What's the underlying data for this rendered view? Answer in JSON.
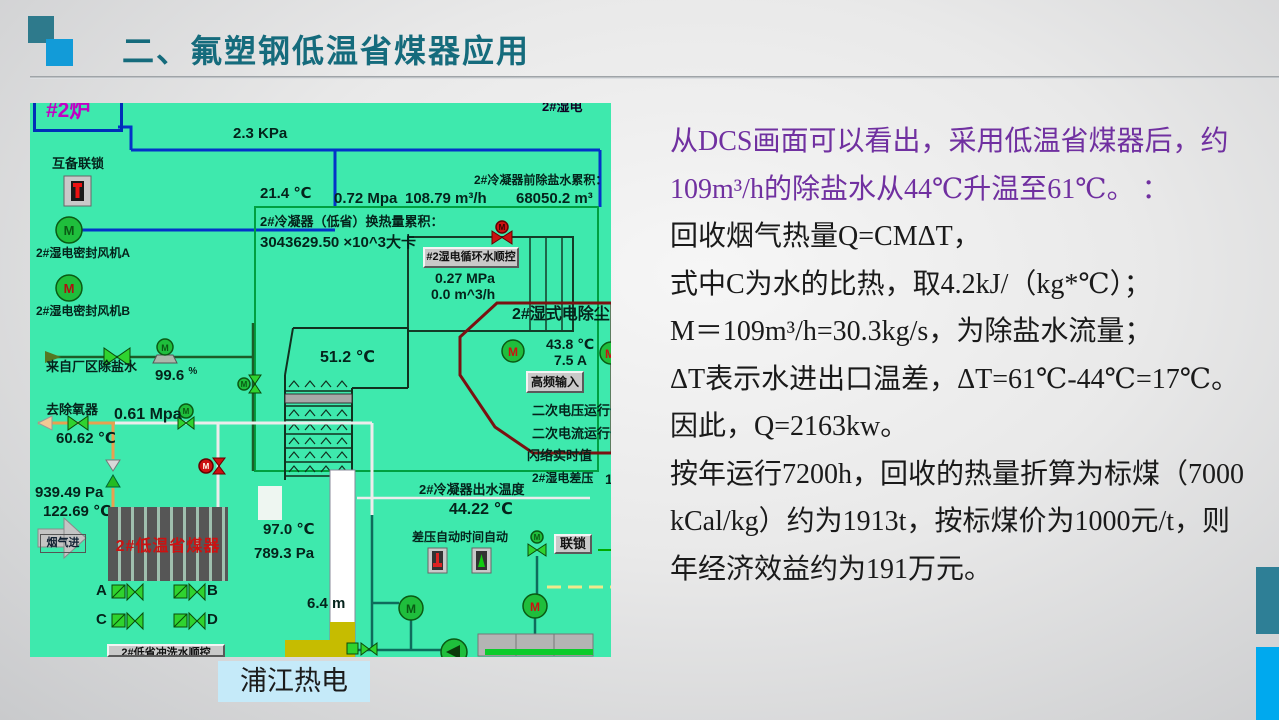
{
  "header": {
    "title": "二、氟塑钢低温省煤器应用"
  },
  "footer": {
    "plant_label": "浦江热电"
  },
  "colors": {
    "title": "#156b7c",
    "purple": "#7030a0",
    "black": "#1a1a1a",
    "econ_red": "#cc1111",
    "magenta": "#c400c4",
    "accent_teal": "#2e7f96",
    "accent_blue": "#00a9ee"
  },
  "annotation": {
    "lines": [
      {
        "text": "从DCS画面可以看出，采用低温省煤器后，约",
        "color": "#7030a0"
      },
      {
        "text": "109m³/h的除盐水从44℃升温至61℃。 ：",
        "color": "#7030a0"
      },
      {
        "text": "回收烟气热量Q=CMΔT，",
        "color": "#1a1a1a"
      },
      {
        "text": "式中C为水的比热，取4.2kJ/（kg*℃）；",
        "color": "#1a1a1a"
      },
      {
        "text": "M＝109m³/h=30.3kg/s，为除盐水流量；",
        "color": "#1a1a1a"
      },
      {
        "text": "ΔT表示水进出口温差，ΔT=61℃-44℃=17℃。",
        "color": "#1a1a1a"
      },
      {
        "text": "因此，Q=2163kw。",
        "color": "#1a1a1a"
      },
      {
        "text": "按年运行7200h，回收的热量折算为标煤（7000",
        "color": "#1a1a1a"
      },
      {
        "text": "kCal/kg）约为1913t，按标煤价为1000元/t，则",
        "color": "#1a1a1a"
      },
      {
        "text": "年经济效益约为191万元。",
        "color": "#1a1a1a"
      }
    ]
  },
  "dcs": {
    "motor": "M",
    "furnace_tag": "#2炉",
    "top_clip": "2#湿电",
    "kpa": "2.3 KPa",
    "interlock": "互备联锁",
    "fan_a": "2#湿电密封风机A",
    "fan_b": "2#湿电密封风机B",
    "t21": "21.4 ℃",
    "p072": "0.72 Mpa",
    "f10879": "108.79 m³/h",
    "acc_label": "2#冷凝器前除盐水累积：",
    "acc_val": "68050.2 m³",
    "heat_label": "2#冷凝器（低省）换热量累积：",
    "heat_val": "3043629.50 ×10^3大卡",
    "seq_btn": "#2湿电循环水顺控",
    "p027": "0.27 MPa",
    "f00": "0.0 m^3/h",
    "t512": "51.2 ℃",
    "esp_title": "2#湿式电除尘",
    "t438": "43.8 ℃",
    "a75": "7.5 A",
    "hf_btn": "高频输入",
    "sec_volt": "二次电压运行值",
    "sec_curr": "二次电流运行值",
    "flash": "闪络实时值",
    "src": "来自厂区除盐水",
    "pct": "99.6",
    "pct_unit": "%",
    "deaerator": "去除氧器",
    "p061": "0.61 Mpa",
    "t6062": "60.62 ℃",
    "p939": "939.49 Pa",
    "t12269": "122.69 ℃",
    "flue": "烟气进",
    "econ": "2#低温省煤器",
    "t970": "97.0 ℃",
    "p7893": "789.3 Pa",
    "va": "A",
    "vb": "B",
    "vc": "C",
    "vd": "D",
    "level": "6.4 m",
    "flush_btn": "2#低省冲洗水顺控",
    "outlet_label": "2#冷凝器出水温度",
    "outlet_val": "44.22 ℃",
    "dp_auto": "差压自动",
    "time_auto": "时间自动",
    "interlock_btn": "联锁",
    "esp_dp": "2#湿电差压",
    "partial1": "1"
  }
}
